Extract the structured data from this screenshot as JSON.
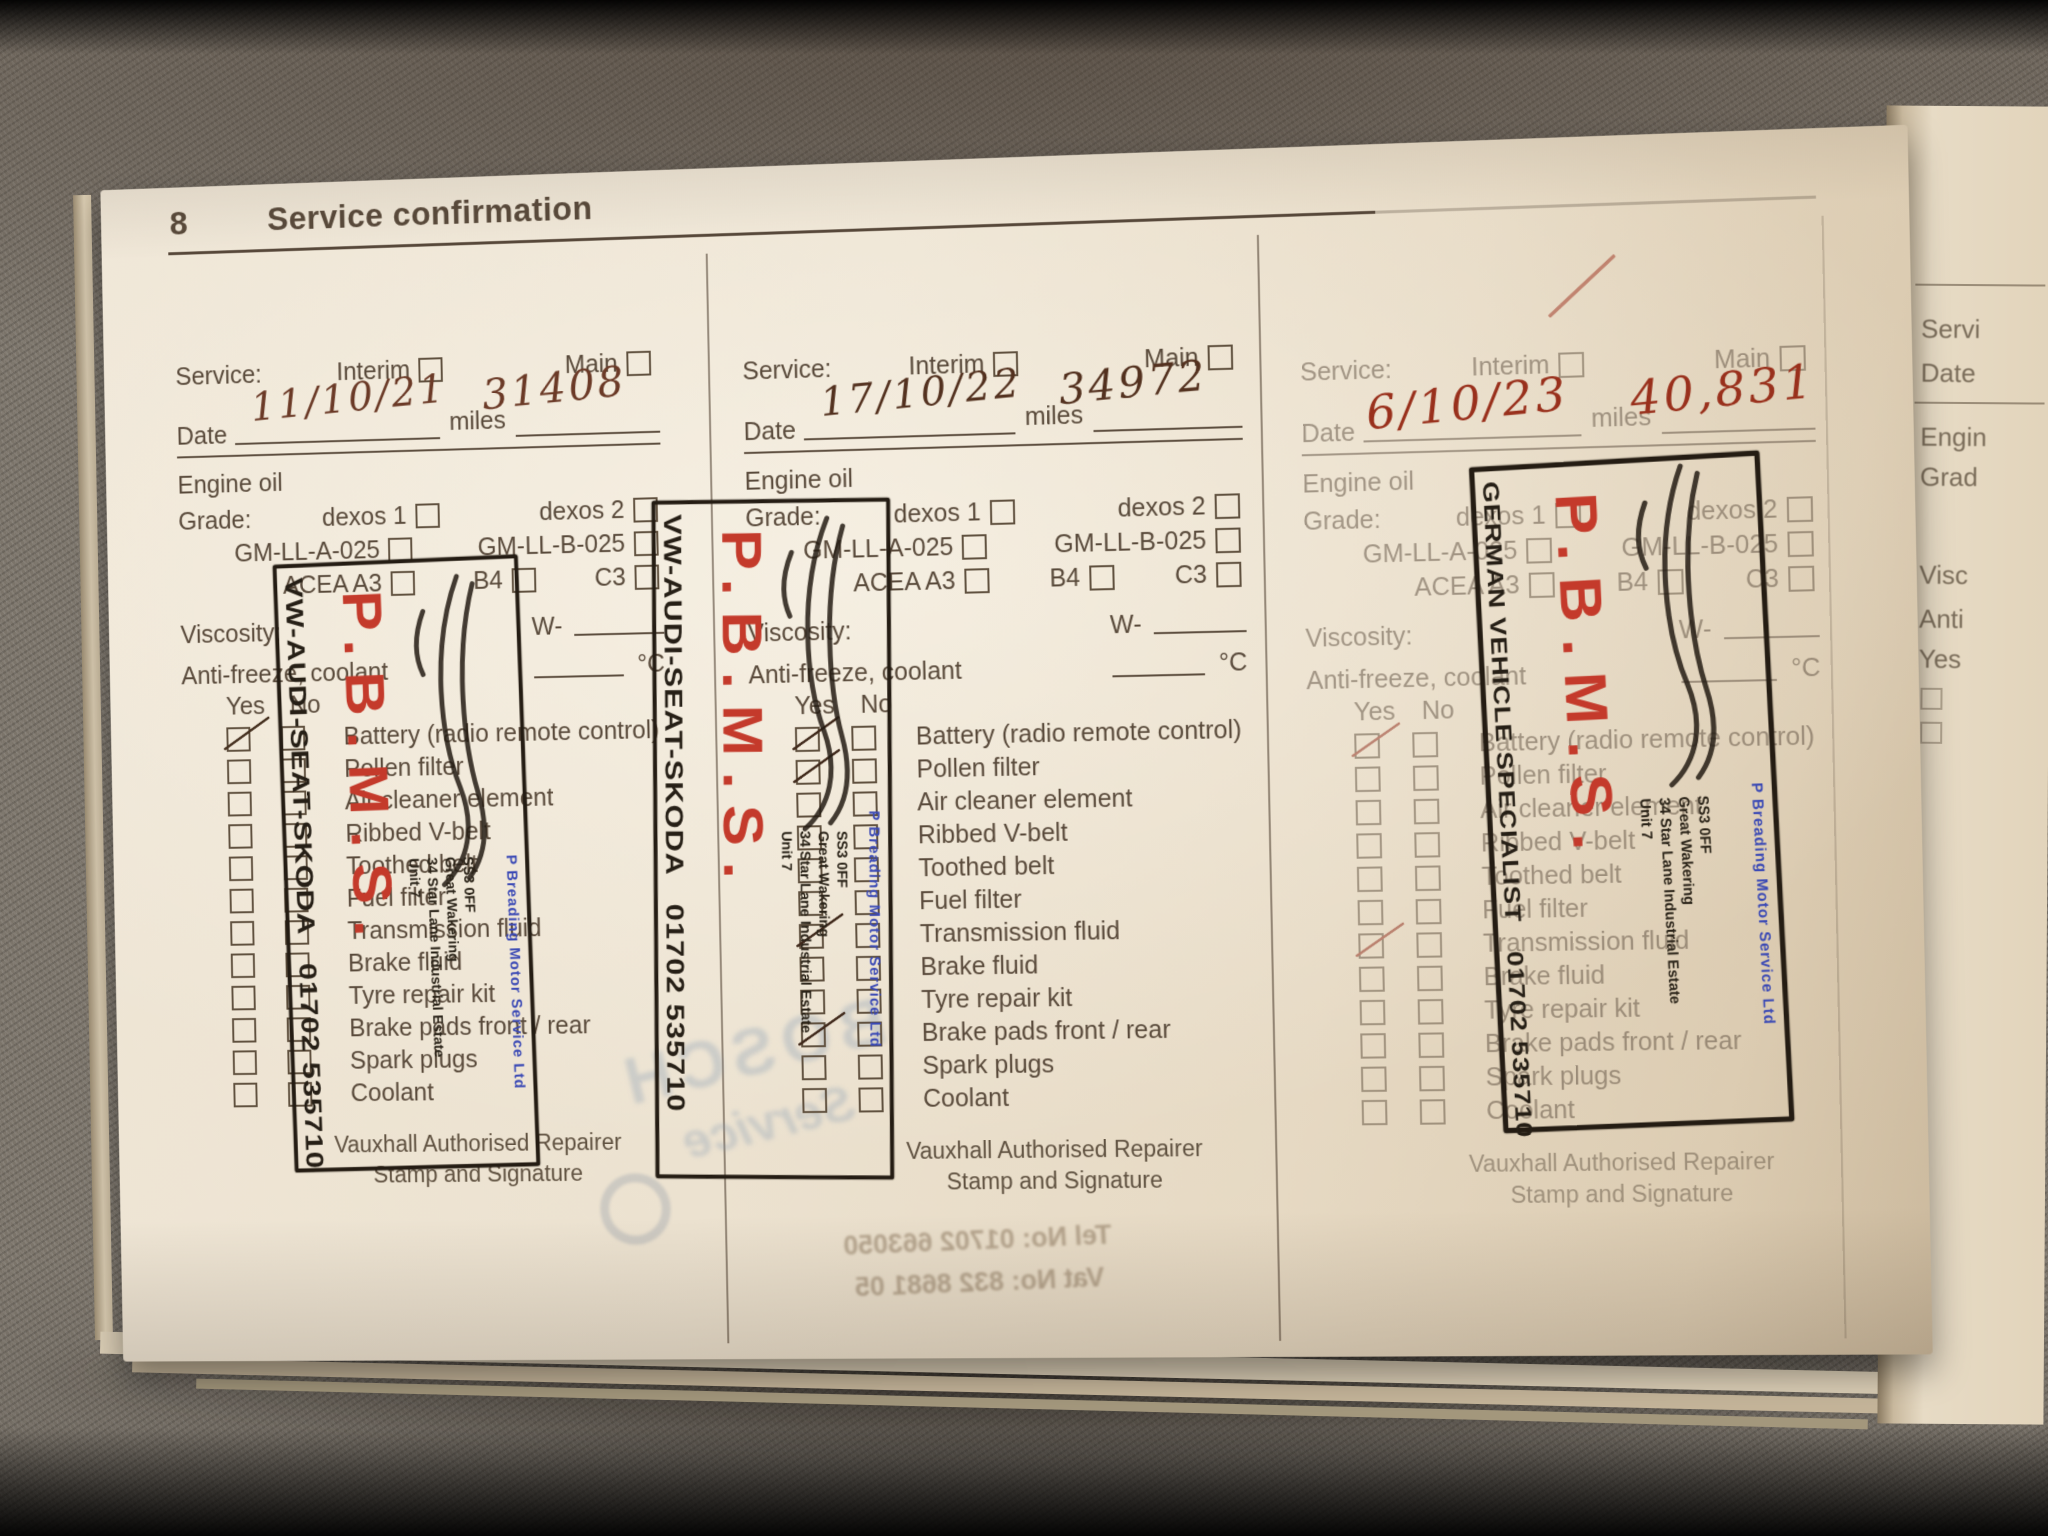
{
  "page": {
    "number": "8",
    "title": "Service confirmation"
  },
  "labels": {
    "service": "Service:",
    "interim": "Interim",
    "main": "Main",
    "date": "Date",
    "miles": "miles",
    "engine_oil": "Engine oil",
    "grade": "Grade:",
    "dexos1": "dexos 1",
    "dexos2": "dexos 2",
    "gm_a": "GM-LL-A-025",
    "gm_b": "GM-LL-B-025",
    "acea_a3": "ACEA A3",
    "b4": "B4",
    "c3": "C3",
    "viscosity": "Viscosity:",
    "w_prefix": "W-",
    "antifreeze": "Anti-freeze, coolant",
    "deg_c": "°C",
    "yes": "Yes",
    "no": "No",
    "footer_line1": "Vauxhall Authorised Repairer",
    "footer_line2": "Stamp and Signature"
  },
  "checklist": [
    "Battery (radio remote control)",
    "Pollen filter",
    "Air cleaner element",
    "Ribbed V-belt",
    "Toothed belt",
    "Fuel filter",
    "Transmission fluid",
    "Brake fluid",
    "Tyre repair kit",
    "Brake pads front / rear",
    "Spark plugs",
    "Coolant"
  ],
  "records": [
    {
      "date": "11/10/21",
      "miles": "31408",
      "interim_ticked": false,
      "ink": "#6b3a27",
      "tick_color": "#45301f",
      "ticks": [
        1
      ],
      "stamp": {
        "company": "VW-AUDI-SEAT-SKODA",
        "phone": "01702 535710",
        "monogram": "P.B.M.S.",
        "trader": "P Breading Motor Service Ltd",
        "address": [
          "Unit 7",
          "34 Star Lane Industrial Estate",
          "Great Wakering",
          "SS3 0FF"
        ]
      }
    },
    {
      "date": "17/10/22",
      "miles": "34972",
      "interim_ticked": false,
      "ink": "#53311f",
      "tick_color": "#40291b",
      "ticks": [
        1,
        2,
        7,
        10
      ],
      "stamp": {
        "company": "VW-AUDI-SEAT-SKODA",
        "phone": "01702 535710",
        "monogram": "P.B.M.S.",
        "trader": "P Breading Motor Service Ltd",
        "address": [
          "Unit 7",
          "34 Star Lane Industrial Estate",
          "Great Wakering",
          "SS3 0FF"
        ]
      }
    },
    {
      "date": "6/10/23",
      "miles": "40,831",
      "interim_ticked": true,
      "ink": "#99301c",
      "tick_color": "#8e2a1a",
      "ticks": [
        1,
        7
      ],
      "stamp": {
        "company": "GERMAN VEHICLE SPECIALIST",
        "phone": "01702 535710",
        "monogram": "P.B.M.S.",
        "trader": "P Breading Motor Service Ltd",
        "address": [
          "Unit 7",
          "34 Star Lane Industrial Estate",
          "Great Wakering",
          "SS3 0FF"
        ]
      }
    }
  ],
  "ghost": {
    "brand": "BOSCH",
    "brand2": "Service",
    "tel": "Tel No: 01702 663050",
    "vat": "Vat No: 832 8681 05"
  },
  "next_page": {
    "fragments": [
      "Servi",
      "Date",
      "Engin",
      "Grad",
      "Visc",
      "Anti",
      "Yes"
    ]
  },
  "colors": {
    "paper": "#ebe0cb",
    "print_ink": "#594a3b",
    "stamp_black": "#261f16",
    "stamp_red": "#c43a2b",
    "stamp_blue": "#3a49b5"
  }
}
